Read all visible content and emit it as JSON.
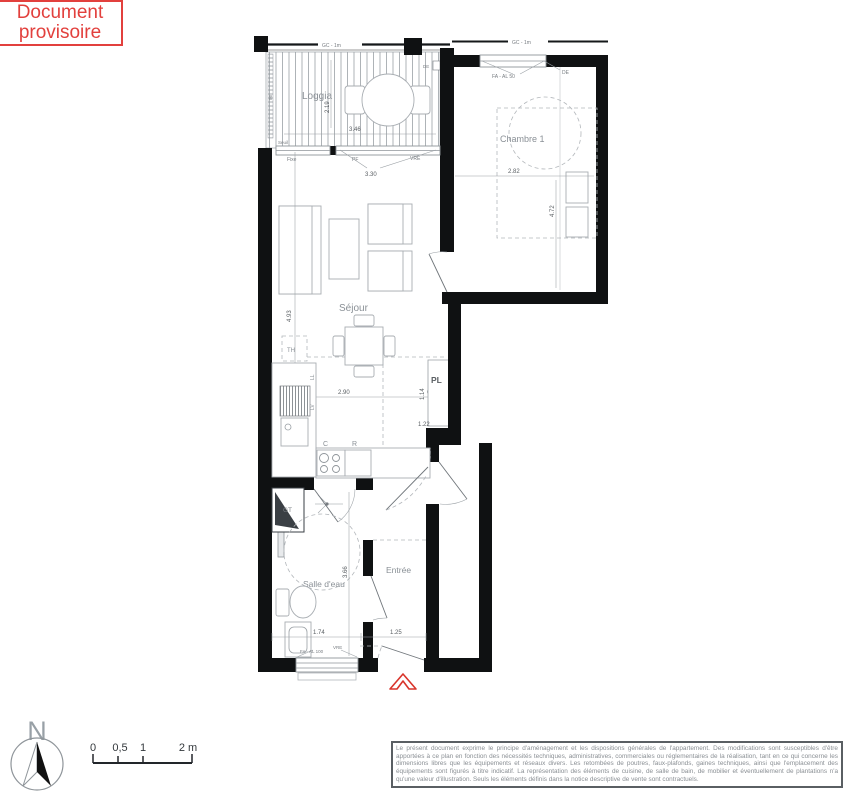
{
  "stamp": {
    "line1": "Document",
    "line2": "provisoire",
    "color": "#e2403d"
  },
  "plan": {
    "rooms": {
      "loggia": "Loggia",
      "chambre": "Chambre 1",
      "sejour": "Séjour",
      "sdb": "Salle d'eau",
      "entree": "Entrée",
      "pl": "PL"
    },
    "labels": {
      "th": "TH",
      "ll": "LL",
      "lv": "LV",
      "c": "C",
      "r": "R",
      "gt": "GT"
    },
    "openings": {
      "gc1": "GC - 1m",
      "gc2": "GC - 1m",
      "seuil": "Seuil",
      "rail86": "86",
      "de_loggia": "DE",
      "fa_al_50": "FA - AL 50",
      "de": "DE",
      "fixe": "Fixe",
      "pf": "PF",
      "vre_sejour": "VRE",
      "fa_al_100": "FA - AL 100",
      "vre_sdb": "VRE"
    },
    "dims": {
      "loggia_h": "2.19",
      "loggia_w": "3.46",
      "sejour_window": "3.30",
      "sejour_h": "4.93",
      "kitchen_w": "2.90",
      "pl_side": "1.14",
      "pl_w": "0.55",
      "pl_b": "1.22",
      "entry_side": "1.24",
      "chambre_w": "2.82",
      "chambre_h": "4.72",
      "sdb_w": "1.74",
      "sdb_h": "3.66",
      "entree_w": "1.25"
    },
    "entry_arrow_color": "#d9342b"
  },
  "legend": {
    "north": "N",
    "scale": {
      "t0": "0",
      "t05": "0,5",
      "t1": "1",
      "t2": "2 m"
    }
  },
  "disclaimer": {
    "text": "Le présent document exprime le principe d'aménagement et les dispositions générales de l'appartement. Des modifications sont susceptibles d'être apportées à ce plan en fonction des nécessités techniques, administratives, commerciales ou réglementaires de la réalisation, tant en ce qui concerne les dimensions libres que les équipements et réseaux divers. Les retombées de poutres, faux-plafonds, gaines techniques, ainsi que l'emplacement des équipements sont figurés à titre indicatif. La représentation des éléments de cuisine, de salle de bain, de mobilier et éventuellement de plantations n'a qu'une valeur d'illustration. Seuls les éléments définis dans la notice descriptive de vente sont contractuels."
  }
}
